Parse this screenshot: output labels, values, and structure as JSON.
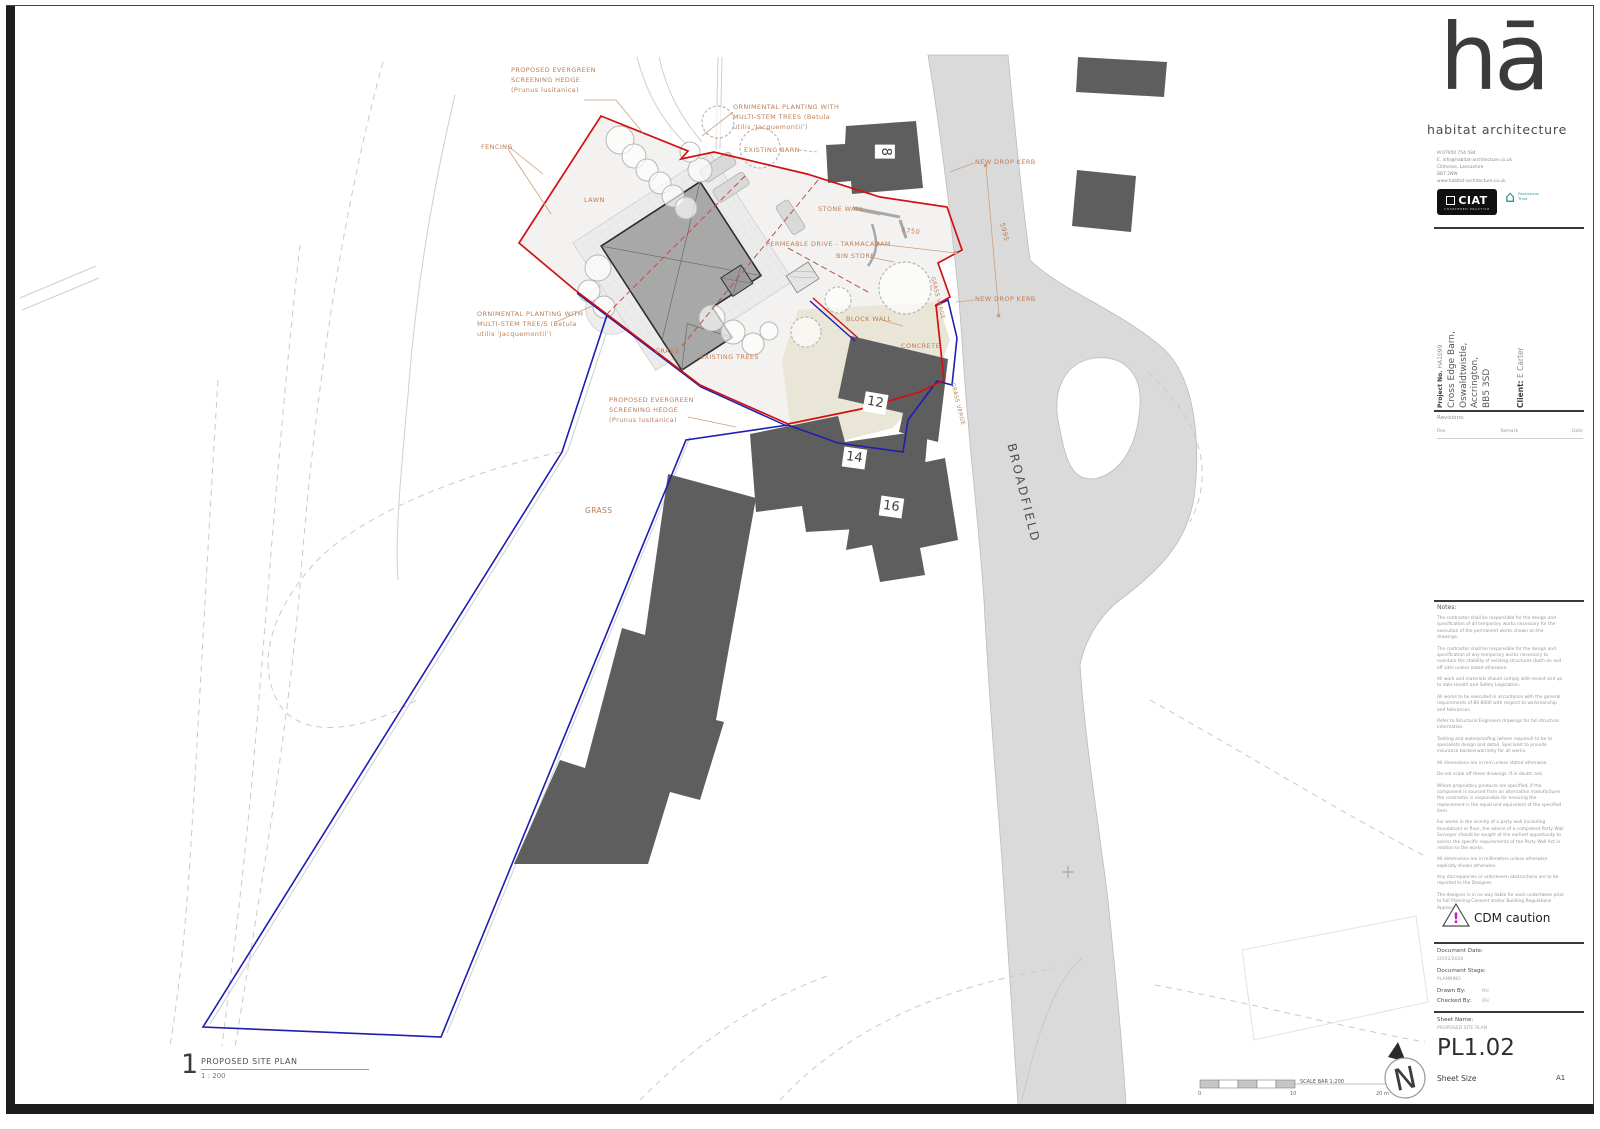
{
  "branding": {
    "logo_text": "hā",
    "firm_name": "habitat architecture",
    "contact_lines": "M 07950 754 584\nE. info@habitat-architecture.co.uk\nClitheroe, Lancashire\nBB7 2NW\nwww.habitat-architecture.co.uk",
    "ciat_label": "CIAT",
    "ciat_sub": "CHARTERED PRACTICE",
    "passivhaus_label": "Passivhaus\nTrust",
    "passivhaus_icon": "⌂"
  },
  "project": {
    "number_label": "Project No.",
    "number": "HA1099",
    "address": "Cross Edge Barn,\nOswaldtwistle,\nAccrington,\nBB5 3SD",
    "client_label": "Client:",
    "client_name": "E Carter"
  },
  "revisions": {
    "title": "Revisions:",
    "col_rev": "Rev.",
    "col_remark": "Remark",
    "col_date": "Date"
  },
  "notes": {
    "title": "Notes:",
    "paragraphs": [
      "The contractor shall be responsible for the design and specification of all temporary works necessary for the execution of the permanent works shown on the drawings.",
      "The contractor shall be responsible for the design and specification of any temporary works necessary to maintain the stability of existing structures (both on and off site) unless noted otherwise.",
      "All work and materials should comply with recent and up to date Health and Safety Legislation.",
      "All works to be executed in accordance with the general requirements of BS 8000 with respect to workmanship and tolerances.",
      "Refer to Structural Engineers drawings for full structure information.",
      "Tanking and waterproofing (where required) to be to specialists design and detail. Specialist to provide insurance backed warranty for all works.",
      "All dimensions are in mm unless stated otherwise.",
      "Do not scale off these drawings. If in doubt, ask.",
      "Where proprietary products are specified, if the component is sourced from an alternative manufacturer the contractor is responsible for ensuring the replacement is the equal and equivalent of the specified item.",
      "For works in the vicinity of a party wall (including foundation) or floor, the advice of a competent Party Wall Surveyor should be sought at the earliest opportunity to assess the specific requirements of the Party Wall Act in relation to the works.",
      "All dimensions are in millimeters unless otherwise explicitly shown otherwise.",
      "Any discrepancies or unforeseen obstructions are to be reported to the Designer.",
      "The designer is in no way liable for work undertaken prior to full Planning Consent and/or Building Regulations Approval."
    ]
  },
  "cdm": {
    "label": "CDM caution",
    "mark": "!"
  },
  "document": {
    "date_label": "Document Date:",
    "date": "20/02/2026",
    "stage_label": "Document Stage:",
    "stage": "PLANNING",
    "drawn_label": "Drawn By:",
    "drawn": "RH",
    "checked_label": "Checked By:",
    "checked": "RH"
  },
  "sheet": {
    "name_label": "Sheet Name:",
    "name": "PROPOSED SITE PLAN",
    "number": "PL1.02",
    "size_label": "Sheet Size",
    "size": "A1"
  },
  "viewport": {
    "number": "1",
    "title": "PROPOSED SITE PLAN",
    "scale": "1 : 200"
  },
  "scale_bar": {
    "label": "SCALE BAR 1:200",
    "tick0": "0",
    "tick10": "10",
    "tick20": "20 m"
  },
  "north": {
    "label": "N"
  },
  "plan_labels": {
    "hedge_top": "PROPOSED EVERGREEN\nSCREENING HEDGE\n(Prunus lusitanica)",
    "fencing": "FENCING",
    "ornamental_top": "ORNIMENTAL PLANTING WITH\nMULTI-STEM TREES (Betula\nutilis 'Jacquemontii')",
    "existing_barn": "EXISTING BARN",
    "lawn": "LAWN",
    "stone_wall": "STONE WALL",
    "drive": "PERMEABLE DRIVE - TARMACADAM",
    "bin_store": "BIN STORE",
    "new_drop_kerb_top": "NEW DROP KERB",
    "new_drop_kerb_bottom": "NEW DROP KERB",
    "grass_verge_top": "GRASS VERGE",
    "grass_verge_bottom": "GRASS VERGE",
    "block_wall": "BLOCK WALL",
    "concrete": "CONCRETE",
    "grass_small": "GRASS",
    "grass_large": "GRASS",
    "existing_trees": "EXISTING TREES",
    "ornamental_left": "ORNIMENTAL PLANTING WITH\nMULTI-STEM TREE/S (Betula\nutilis 'Jacquemontii')",
    "hedge_lower": "PROPOSED EVERGREEN\nSCREENING HEDGE\n(Prunus lusitanica)",
    "road_name": "BROADFIELD",
    "dim_5750": "5750",
    "dim_5995": "5995",
    "house_8": "8",
    "house_12": "12",
    "house_14": "14",
    "house_16": "16"
  }
}
